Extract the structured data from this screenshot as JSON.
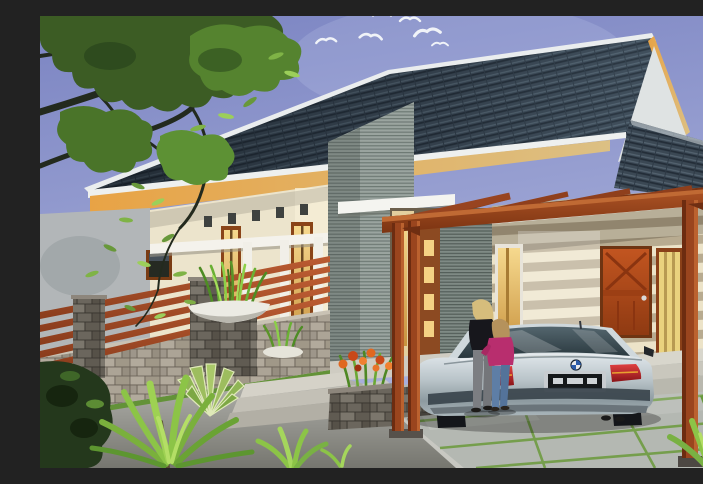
{
  "scene": {
    "title": "Modern tropical house exterior rendering",
    "setting": "daytime",
    "description": "3D architectural rendering of a single-storey modern house with a dark tiled gable roof, ribbed stone accent tower, timber pergola carport, silver sedan parked under it, and a woman with a child standing beside the car",
    "objects": [
      "sky",
      "flying-birds",
      "frangipani-tree",
      "tiled-gable-roof",
      "ribbed-stone-tower",
      "entry-porch",
      "bowl-planter",
      "front-door",
      "timber-pergola-carport",
      "silver-sedan",
      "woman",
      "child",
      "stone-fence-wall",
      "flower-planter-box",
      "garden-plants",
      "asphalt-road",
      "paving-slabs"
    ],
    "counts": {
      "birds": 6,
      "people": 2,
      "vehicles": 1
    }
  },
  "palette": {
    "sky_top": "#7b84c2",
    "sky_bottom": "#aeb4de",
    "roof_tile": "#36424e",
    "roof_fascia": "#eaedee",
    "gable_fascia": "#d8bc80",
    "eave_soffit": "#e8a345",
    "wall_cream": "#ece4cc",
    "wall_band": "#b8ab90",
    "stone_cladding": "#9aa49f",
    "timber_pergola": "#9a451e",
    "front_door": "#b04818",
    "window_glow": "#f0c878",
    "car_silver": "#c6d0d4",
    "taillight": "#b02828",
    "foliage": "#5d9134",
    "road": "#9a9a96",
    "grass_joint": "#6f9c42",
    "woman_top": "#17171c",
    "girl_jacket": "#b82e6e",
    "jeans": "#5e7ea6"
  }
}
